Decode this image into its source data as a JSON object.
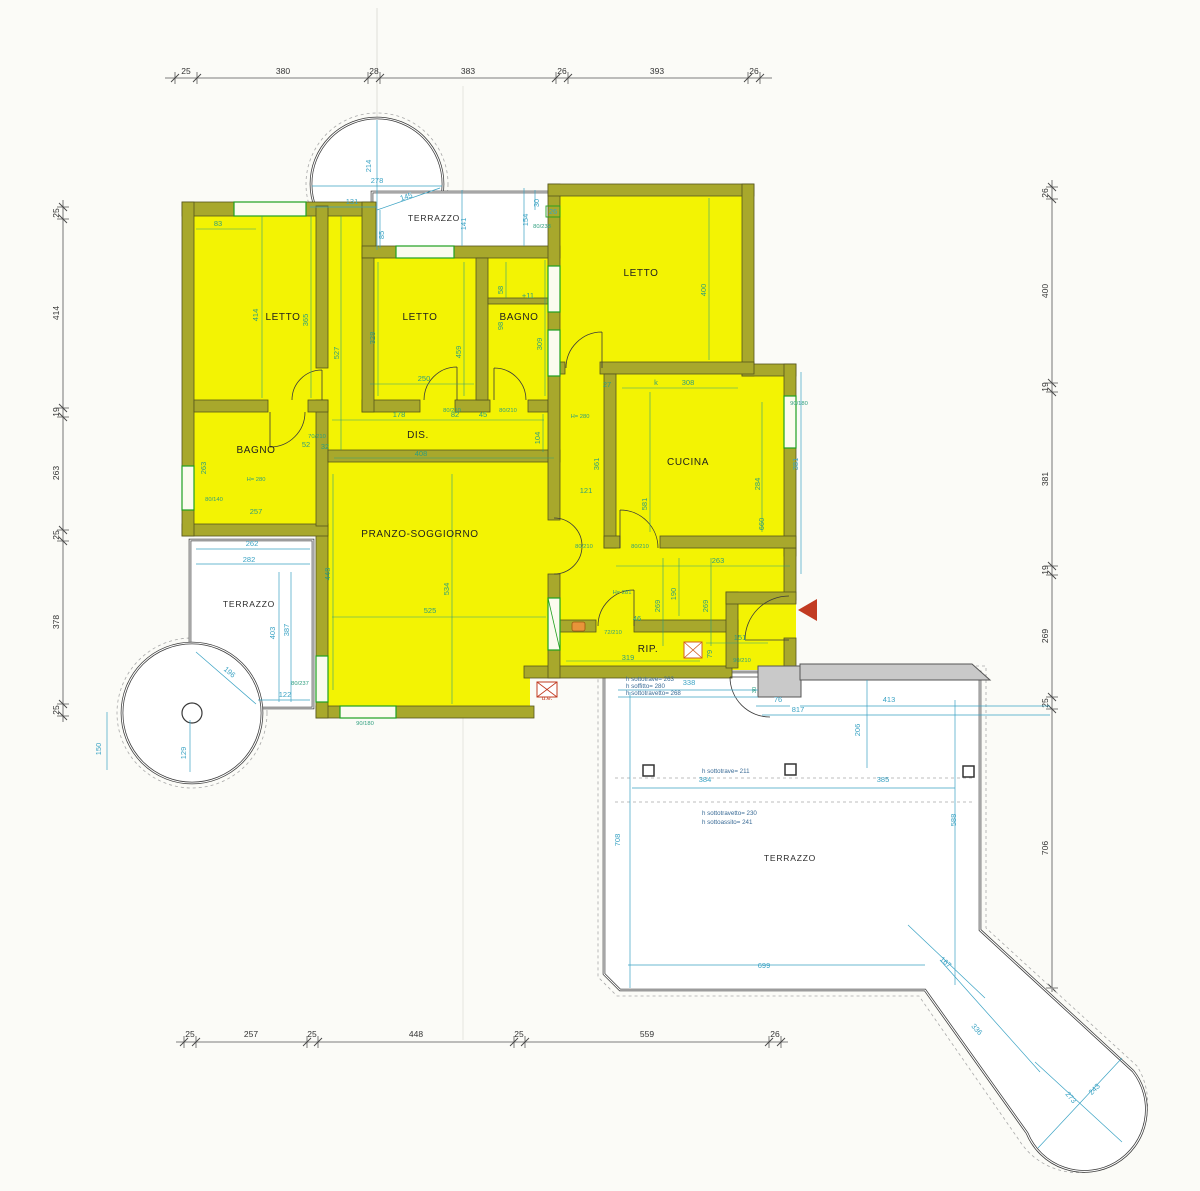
{
  "drawing": {
    "kind": "apartment floor plan",
    "language": "italian"
  },
  "colors": {
    "room_fill": "#f3f303",
    "wall_fill": "#a8a82c",
    "wall_edge": "#55551c",
    "dim_blue": "#3ba3c4",
    "dim_teal": "#2e9e7e",
    "red": "#c23b22",
    "paper": "#fbfbf7",
    "parapet_gray": "#c9c9c9",
    "hatch_grid": "#c9d5e3"
  },
  "chains": {
    "top": [
      "25",
      "380",
      "28",
      "383",
      "26",
      "393",
      "26"
    ],
    "left": [
      "25",
      "414",
      "19",
      "263",
      "25",
      "378",
      "25"
    ],
    "right": [
      "26",
      "400",
      "19",
      "381",
      "19",
      "269",
      "25",
      "706"
    ],
    "bottom": [
      "25",
      "257",
      "25",
      "448",
      "25",
      "559",
      "26"
    ]
  },
  "rooms": {
    "letto_nw": "LETTO",
    "letto_n": "LETTO",
    "letto_ne": "LETTO",
    "bagno_n": "BAGNO",
    "bagno_w": "BAGNO",
    "cucina": "CUCINA",
    "dis": "DIS.",
    "pranzo": "PRANZO-SOGGIORNO",
    "rip": "RIP.",
    "terr_top": "TERRAZZO",
    "terr_left": "TERRAZZO",
    "terr_big": "TERRAZZO"
  },
  "dims": {
    "d83": "83",
    "d414": "414",
    "d365": "365",
    "d527": "527",
    "d328": "328",
    "d459": "459",
    "d250": "250",
    "d178": "178",
    "d82": "82",
    "d45": "45",
    "d58": "58",
    "d98": "98",
    "dplus11": "+11",
    "d309": "309",
    "d400": "400",
    "dk": "k",
    "d308": "308",
    "d27": "27",
    "d361": "361",
    "d104": "104",
    "d121": "121",
    "d581": "581",
    "d284": "284",
    "d660": "660",
    "d263k": "263",
    "d408": "408",
    "d52": "52",
    "d32": "32",
    "d263b": "263",
    "d257": "257",
    "d448": "448",
    "d525": "525",
    "d534": "534",
    "d190": "190",
    "d269a": "269",
    "d269b": "269",
    "d319": "319",
    "d46": "46",
    "d151": "151",
    "d79": "79"
  },
  "heights": {
    "h280a": "H= 280",
    "h280b": "H= 280",
    "h281": "H= 281"
  },
  "fractions": {
    "f70210": "70/210",
    "f80140": "80/140",
    "f80210a": "80/210",
    "f80210b": "80/210",
    "f80210c": "80/210",
    "f80210d": "80/210",
    "f90210": "90/210",
    "f90180": "90/180",
    "f90180b": "90/180",
    "f80238": "80/238",
    "f80237": "80/237",
    "f72210": "72/210"
  },
  "blue": {
    "b381": "381",
    "b278": "278",
    "b214": "214",
    "b131": "131",
    "b145": "145",
    "b85": "85",
    "b141": "141",
    "b154": "154",
    "b30": "30",
    "b26": "26",
    "b262": "262",
    "b282": "282",
    "b403": "403",
    "b387": "387",
    "b196": "196",
    "b122": "122",
    "b129": "129",
    "b150": "150",
    "b338": "338",
    "b30b": "30",
    "b76": "76",
    "b817": "817",
    "b413": "413",
    "b206": "206",
    "b384": "384",
    "b385": "385",
    "b708": "708",
    "b588": "588",
    "b699": "699",
    "b167": "167",
    "b336": "336",
    "b273": "273",
    "b243": "243"
  },
  "notes": {
    "n1": "h sottotrave= 263",
    "n2": "h soffitto= 280",
    "n3": "h sottotravetto= 268",
    "n4": "h sottotrave= 211",
    "n5": "h sottotravetto= 230",
    "n6": "h sottoassito= 241"
  },
  "marks": {
    "ue": "u.e."
  }
}
